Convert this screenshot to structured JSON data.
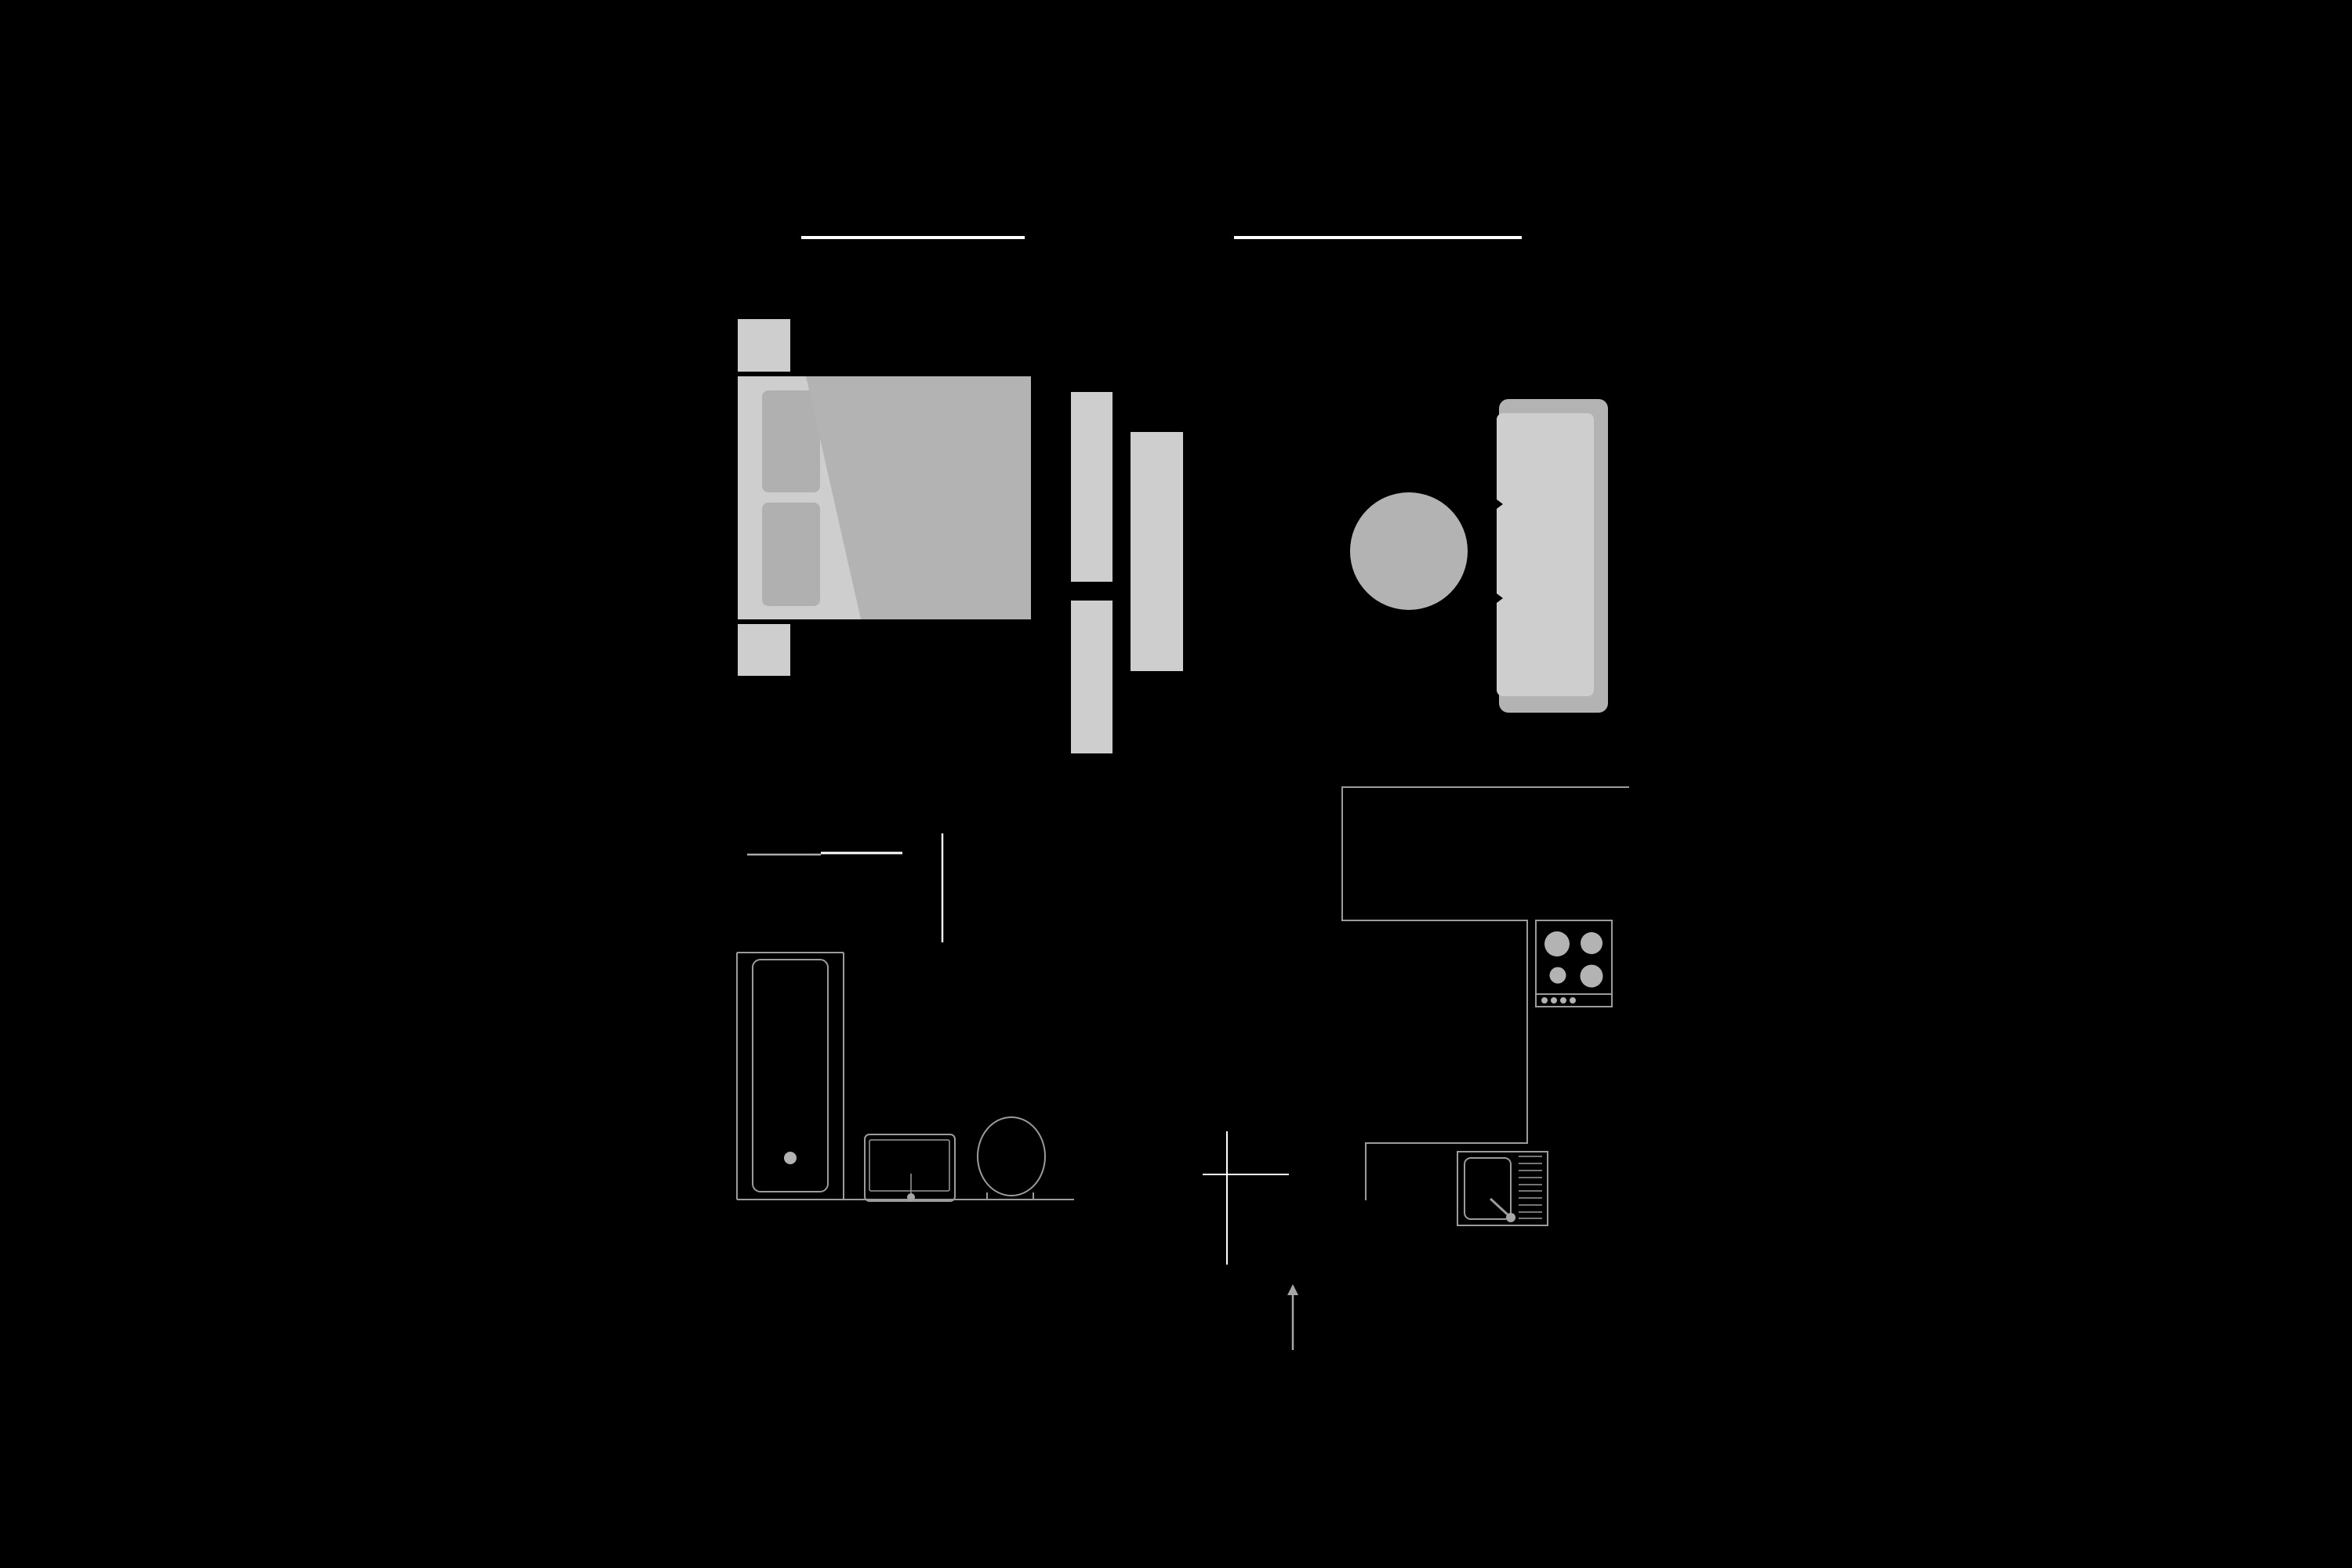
{
  "title": "apartment-floor-plan",
  "colors": {
    "background": "#000000",
    "wall_white": "#ffffff",
    "wall_bright": "#f0f0f0",
    "outline_gray": "#9b9b9b",
    "door_gray": "#ababab",
    "furniture_light": "#cecece",
    "furniture_medium": "#b3b3b3",
    "pillow_gray": "#b0b0b0",
    "arrow_gray": "#a6a6a6"
  },
  "plan": {
    "style": "dark floor plan, gray furniture fills and thin gray outlines on black",
    "windows": [
      {
        "name": "bedroom-window",
        "wall": "top"
      },
      {
        "name": "living-room-window",
        "wall": "top"
      }
    ],
    "bedroom": {
      "items": [
        "nightstand-top",
        "nightstand-bottom",
        "bed",
        "pillow x2",
        "duvet-with-fold",
        "wardrobe-panel x2",
        "dresser-panel"
      ]
    },
    "living_room": {
      "items": [
        "round-table",
        "sofa-with-backrest",
        "seat-cushions"
      ]
    },
    "bathroom": {
      "items": [
        "bathtub",
        "bathtub-drain",
        "washbasin",
        "basin-faucet",
        "toilet"
      ],
      "door_segments": 2
    },
    "kitchen": {
      "items": [
        "l-shaped-counter",
        "cooktop"
      ],
      "cooktop_burners": 4,
      "cooktop_knobs": 4,
      "sink": [
        "sink-unit",
        "sink-basin",
        "sink-faucet",
        "drainboard-10-lines"
      ]
    },
    "symbols": [
      "cross-marker",
      "entrance-arrow-up"
    ]
  }
}
